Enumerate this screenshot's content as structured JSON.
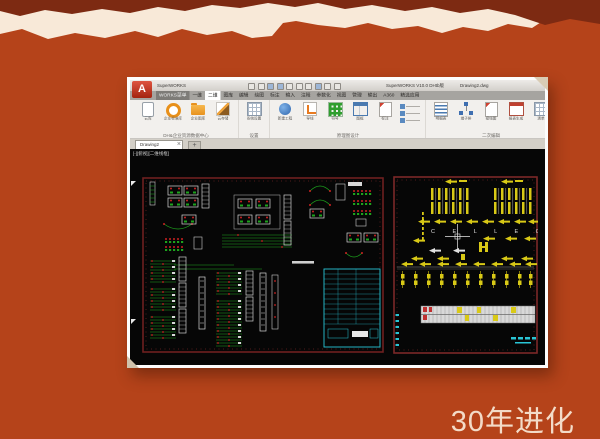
{
  "slide": {
    "caption": "30年进化"
  },
  "colors": {
    "background_orange": "#b5431a",
    "top_band_dark": "#7d2a12",
    "torn_paper_cream": "#f8e9d8",
    "caption_text": "#f3dbc8",
    "canvas_black": "#060606",
    "schematic_green": "#1da31d",
    "schematic_red": "#cc2222",
    "schematic_cyan": "#29c5d6",
    "schematic_yellow": "#d9c916",
    "sheet_border_maroon": "#6e2020"
  },
  "window": {
    "titlebar": {
      "app_button": "A",
      "app_name": "SuperWORKS",
      "version_title": "SuperWORKS V10.0 DHtb版",
      "file_title": "Drawing2.dwg",
      "quick_icons": [
        "new-icon",
        "open-icon",
        "save-icon",
        "print-icon",
        "undo-icon",
        "redo-icon",
        "refresh-icon",
        "view-icon",
        "settings-icon",
        "help-icon"
      ]
    },
    "menu_tabs": [
      "WORKS菜单",
      "一维",
      "二维",
      "图库",
      "编辑",
      "绘图",
      "标注",
      "输入",
      "注释",
      "参数化",
      "视图",
      "管理",
      "输出",
      "A360",
      "精选应用"
    ],
    "ribbon": {
      "groups": [
        {
          "label": "DH&企业资源数据中心",
          "icons": [
            {
              "name": "tablet-icon",
              "label": "云库"
            },
            {
              "name": "ring-icon",
              "label": "企业标准库"
            },
            {
              "name": "folder-icon",
              "label": "企业图库"
            },
            {
              "name": "pen-icon",
              "label": "云存储"
            }
          ]
        },
        {
          "label": "设置",
          "icons": [
            {
              "name": "frame-icon",
              "label": "系统设置"
            }
          ]
        },
        {
          "label": "原理图设计",
          "icons": [
            {
              "name": "globe-icon",
              "label": "新建工程"
            },
            {
              "name": "wire-icon",
              "label": "导线"
            },
            {
              "name": "grid-icon",
              "label": "符号"
            },
            {
              "name": "table-blue-icon",
              "label": "图框"
            },
            {
              "name": "doc-icon",
              "label": "标注"
            }
          ]
        },
        {
          "label": "二次编辑",
          "icons": [
            {
              "name": "list-icon",
              "label": "明细表"
            },
            {
              "name": "orgchart-icon",
              "label": "端子排"
            },
            {
              "name": "doc2-icon",
              "label": "接线图"
            },
            {
              "name": "table-red-icon",
              "label": "报表生成"
            },
            {
              "name": "table-grid-icon",
              "label": "清单"
            }
          ]
        }
      ]
    },
    "doc_tabs": {
      "active": "Drawing2",
      "close_glyph": "×",
      "add_glyph": "+"
    },
    "canvas": {
      "viewport_label": "[-][俯视][二维线框]",
      "right_sheet_letters": "C E L L E C"
    }
  }
}
